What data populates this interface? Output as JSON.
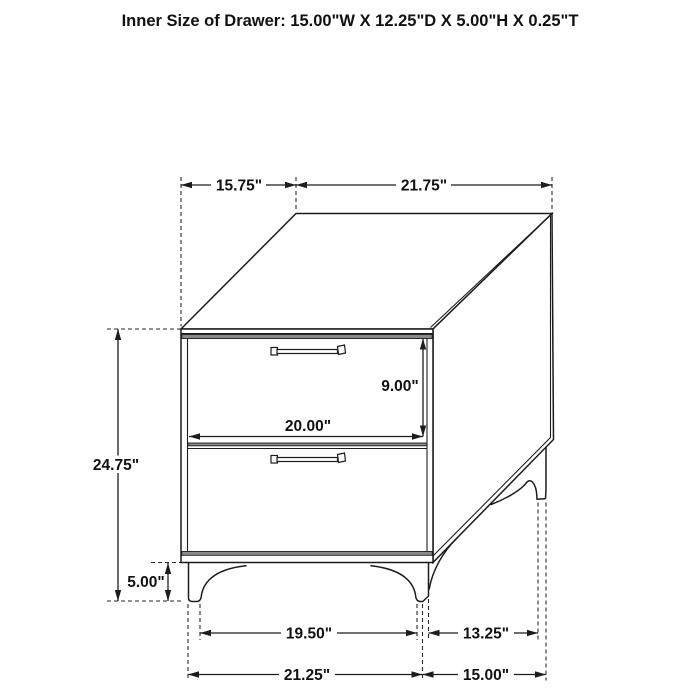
{
  "title": "Inner Size of Drawer: 15.00\"W X 12.25\"D X 5.00\"H X 0.25\"T",
  "dimensions": {
    "top_depth": "15.75\"",
    "top_width": "21.75\"",
    "overall_height": "24.75\"",
    "drawer_opening_height": "9.00\"",
    "drawer_width": "20.00\"",
    "leg_height": "5.00\"",
    "front_legs_inner_span": "19.50\"",
    "side_legs_inner_span": "13.25\"",
    "base_width": "21.25\"",
    "base_depth": "15.00\""
  },
  "colors": {
    "line": "#1c1c1c",
    "shadow_band": "#8a8a8a",
    "background": "#ffffff",
    "text": "#111111"
  }
}
